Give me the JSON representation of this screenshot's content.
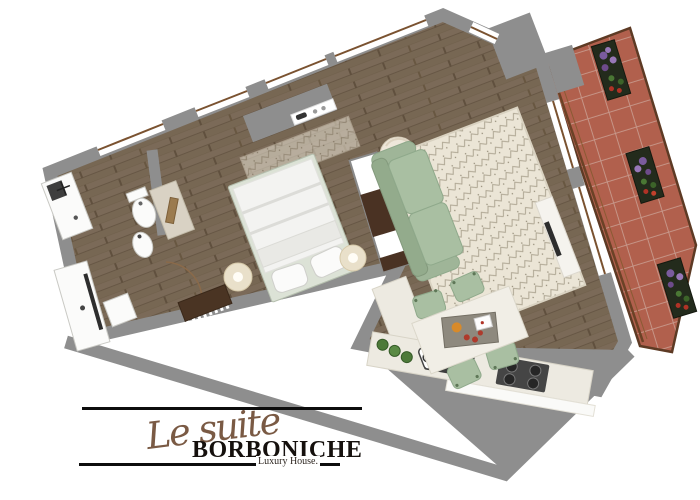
{
  "logo": {
    "script": "Le suite",
    "brand": "BORBONICHE",
    "tagline": "Luxury House."
  },
  "palette": {
    "wall_gray": "#8e8e8e",
    "wood_brown": "#7b6a58",
    "wood_line": "#675745",
    "terrace_tile": "#b1604d",
    "terrace_grout": "#c89a8d",
    "sofa_green": "#a9bfa2",
    "rug_cream": "#ebe5d6",
    "counter_cream": "#edeae1",
    "planter_dark": "#232b1c",
    "flower_purple": "#7a5b9e",
    "flower_red": "#b03226",
    "leaf_green": "#4a7734",
    "door_mat_brown": "#4a3423",
    "logo_script": "#7a5a44",
    "logo_ink": "#15100d"
  },
  "floorplan": {
    "rooms": [
      "bathroom",
      "hallway",
      "bedroom",
      "living-room",
      "kitchen",
      "terrace"
    ],
    "furniture_icons": [
      "shower",
      "vanity-sink",
      "toilet",
      "bidet",
      "door-arc",
      "wardrobe",
      "double-bed",
      "pillows",
      "floor-lamp",
      "floor-lamp",
      "entrance-mat",
      "sofa",
      "pouf",
      "rug",
      "tv-console",
      "dining-table",
      "dining-chair",
      "dining-chair",
      "dining-chair",
      "dining-chair",
      "kitchen-sink",
      "cooktop",
      "plant-pots",
      "terrace-planter",
      "terrace-planter",
      "terrace-planter"
    ],
    "terrace_planter_count": 3
  }
}
